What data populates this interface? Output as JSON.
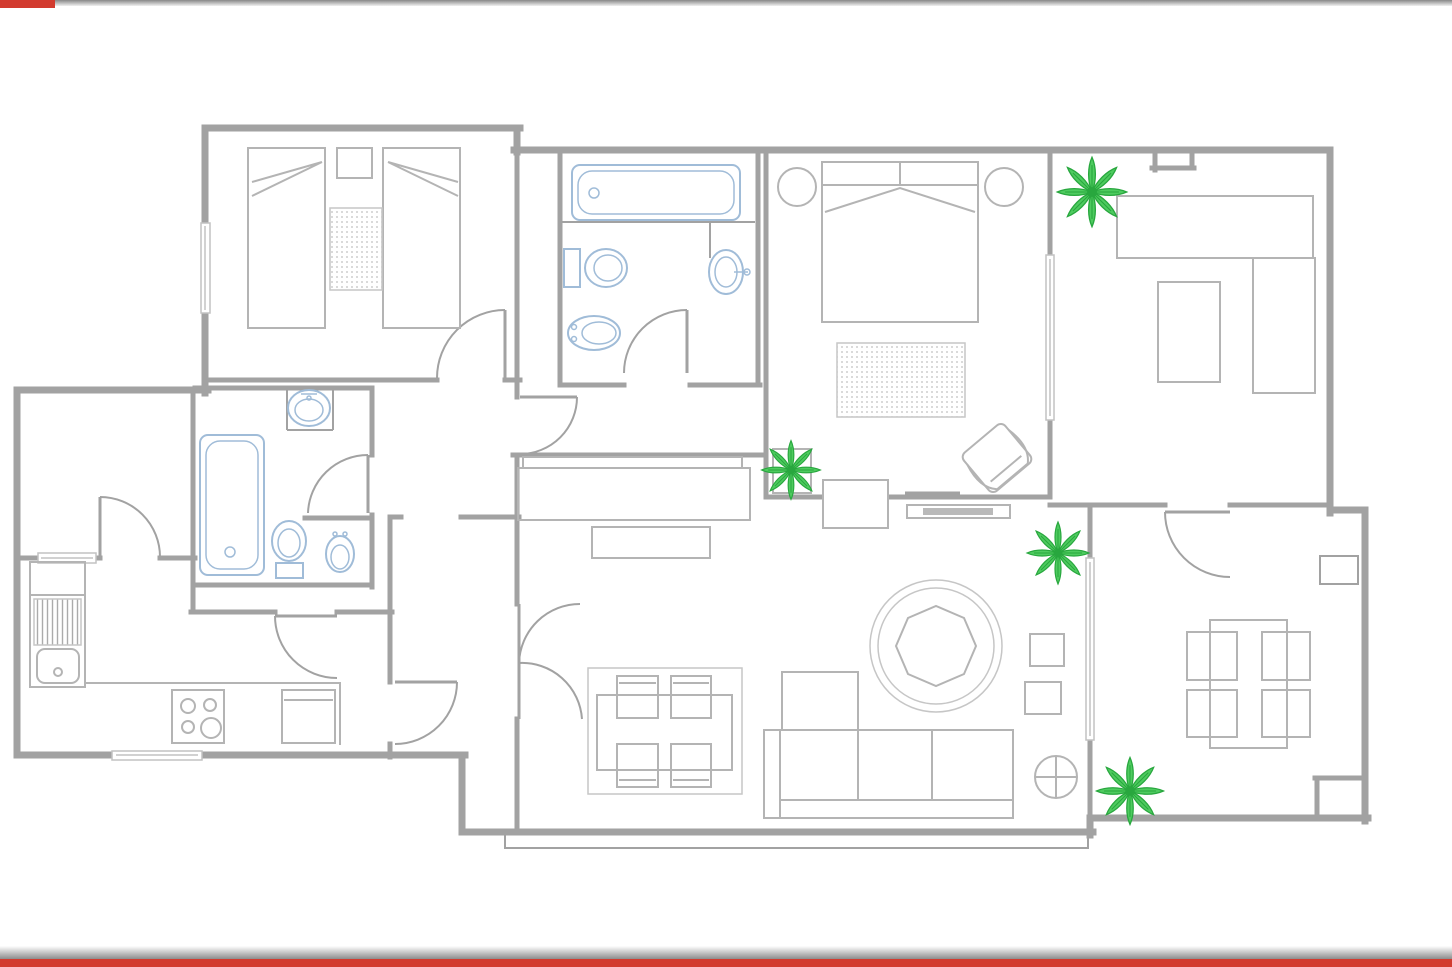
{
  "title": "apartment-floor-plan",
  "canvas": {
    "width": 1452,
    "height": 967,
    "background": "#ffffff"
  },
  "edge_bars": {
    "top_grey": "#878787",
    "bottom_grey": "#8d8d8d",
    "red_accent": "#d23b2f",
    "top_red_width_px": 55
  },
  "colors": {
    "wall": "#a2a2a2",
    "furniture": "#b4b4b4",
    "fixture": "#a0bcd8",
    "plantFill": "#4ecb5f",
    "plantStroke": "#28a73e",
    "rugDot": "#bfbfbf",
    "rugLine": "#c6c6c6",
    "accentRed": "#d23b2f"
  },
  "plan": {
    "type": "floor-plan",
    "style": "CAD line drawing, no text labels",
    "plants_count": 4,
    "door_arcs_count": 10,
    "rooms": [
      {
        "name": "twin-bedroom",
        "position": "top-left",
        "furniture": [
          "twin-bed",
          "twin-bed",
          "nightstand",
          "dotted-rug",
          "window-left-wall"
        ]
      },
      {
        "name": "main-bathroom",
        "position": "top-center",
        "fixtures": [
          "bathtub-horizontal",
          "toilet",
          "bidet",
          "washbasin-in-niche"
        ]
      },
      {
        "name": "master-bedroom",
        "position": "top-center-right",
        "furniture": [
          "double-bed",
          "round-nightstand",
          "round-nightstand",
          "dotted-rug",
          "rotated-armchair",
          "tv",
          "tv-bench",
          "doorway-threshold"
        ]
      },
      {
        "name": "study",
        "position": "top-right",
        "furniture": [
          "l-shaped-desk",
          "desk-return",
          "chair-rect",
          "plant"
        ]
      },
      {
        "name": "hallway",
        "position": "center",
        "furniture": [
          "long-sideboard-with-shelf",
          "bench",
          "plant-at-junction"
        ]
      },
      {
        "name": "second-bathroom",
        "position": "center-left",
        "fixtures": [
          "bathtub-vertical",
          "washbasin-in-niche",
          "toilet",
          "bidet"
        ]
      },
      {
        "name": "utility-room",
        "position": "far-left",
        "furniture": [
          "window"
        ]
      },
      {
        "name": "kitchen",
        "position": "bottom-left",
        "furniture": [
          "sink-with-drainer",
          "upper-cabinet",
          "counter",
          "hob-4-burners",
          "appliance"
        ]
      },
      {
        "name": "dining-area",
        "position": "bottom-center",
        "furniture": [
          "rug",
          "table",
          "chair",
          "chair",
          "chair",
          "chair"
        ]
      },
      {
        "name": "living-room",
        "position": "bottom-center-right",
        "furniture": [
          "round-rug",
          "octagon-coffee-table",
          "sectional-sofa-with-chaise",
          "side-table",
          "side-table",
          "floor-lamp-circle-cross",
          "plant"
        ]
      },
      {
        "name": "terrace-room",
        "position": "bottom-right",
        "furniture": [
          "table",
          "chair",
          "chair",
          "chair",
          "chair",
          "plant",
          "column-box"
        ]
      }
    ]
  }
}
